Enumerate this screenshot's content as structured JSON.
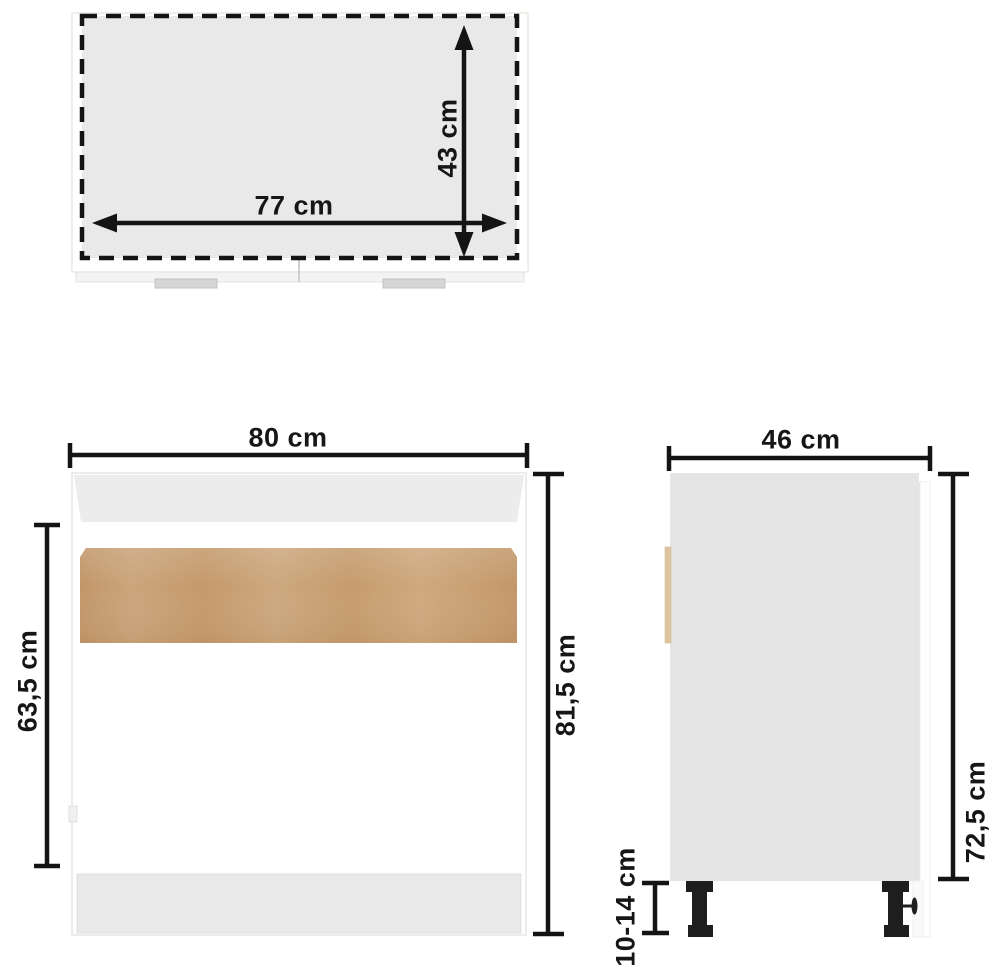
{
  "diagram": {
    "kind": "furniture-dimension-diagram",
    "views": {
      "top": {
        "width_label": "77 cm",
        "depth_label": "43 cm"
      },
      "front": {
        "width_label": "80 cm",
        "door_height_label": "63,5 cm",
        "total_height_label": "81,5 cm"
      },
      "side": {
        "depth_label": "46 cm",
        "body_height_label": "72,5 cm",
        "leg_height_label": "10-14 cm"
      }
    },
    "colors": {
      "background": "#ffffff",
      "ink": "#161616",
      "top_view_fill": "#e9e9e9",
      "front_top_rail_gray": "#ececec",
      "side_panel_gray": "#e5e5e5",
      "plinth_gray": "#e9e9e9",
      "wood_tan": "#c79f73",
      "back_panel_tan": "#dcc59e",
      "handle_gray": "#d6d6d6",
      "leg_black": "#1e1e1e"
    }
  }
}
